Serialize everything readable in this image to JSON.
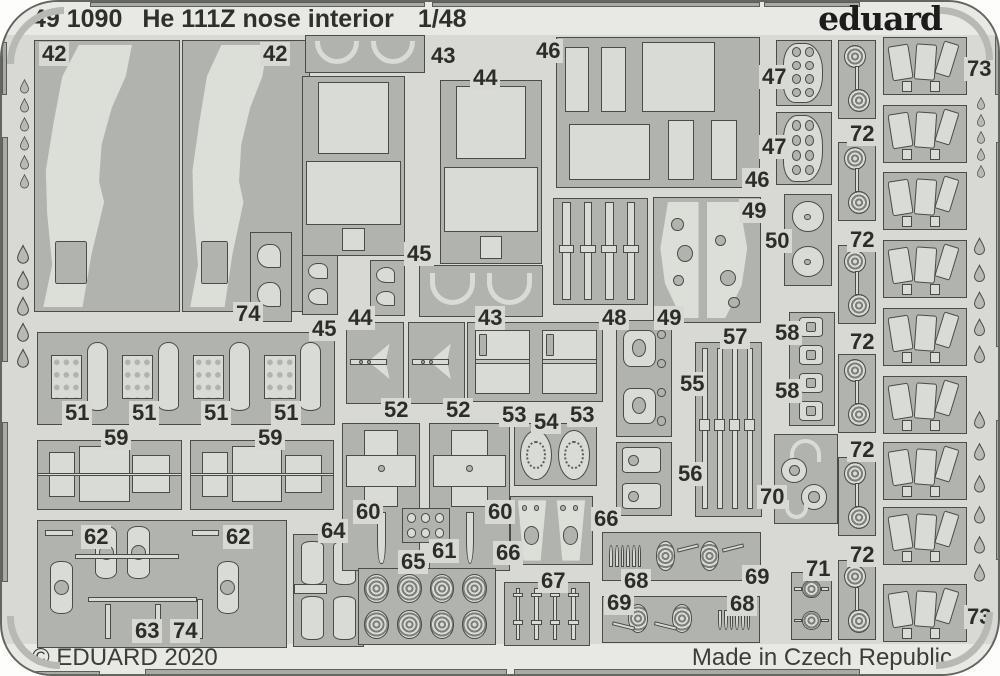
{
  "header": {
    "catalog_number": "49 1090",
    "title": "He 111Z nose interior",
    "scale": "1/48",
    "brand": "eduard"
  },
  "footer": {
    "copyright": "© EDUARD 2020",
    "made_in": "Made in Czech Republic"
  },
  "colors": {
    "sheet": "#d8d9d5",
    "margin_band": "#e8e9e5",
    "cluster_panel": "#b1b4ae",
    "part_fill": "#d9dbd6",
    "outline": "#4a4c46",
    "label_text": "#2b2d29",
    "page": "#fdfdfc"
  },
  "fret": {
    "part_labels": [
      {
        "text": "42",
        "x": 37,
        "y": 40
      },
      {
        "text": "42",
        "x": 258,
        "y": 40
      },
      {
        "text": "43",
        "x": 426,
        "y": 42
      },
      {
        "text": "44",
        "x": 468,
        "y": 64
      },
      {
        "text": "46",
        "x": 531,
        "y": 37
      },
      {
        "text": "47",
        "x": 757,
        "y": 63
      },
      {
        "text": "47",
        "x": 757,
        "y": 133
      },
      {
        "text": "46",
        "x": 740,
        "y": 166
      },
      {
        "text": "49",
        "x": 737,
        "y": 197
      },
      {
        "text": "50",
        "x": 760,
        "y": 227
      },
      {
        "text": "45",
        "x": 402,
        "y": 240
      },
      {
        "text": "74",
        "x": 231,
        "y": 300
      },
      {
        "text": "45",
        "x": 307,
        "y": 315
      },
      {
        "text": "44",
        "x": 343,
        "y": 304
      },
      {
        "text": "43",
        "x": 473,
        "y": 304
      },
      {
        "text": "48",
        "x": 597,
        "y": 304
      },
      {
        "text": "49",
        "x": 652,
        "y": 304
      },
      {
        "text": "51",
        "x": 60,
        "y": 399
      },
      {
        "text": "51",
        "x": 127,
        "y": 399
      },
      {
        "text": "51",
        "x": 199,
        "y": 399
      },
      {
        "text": "51",
        "x": 269,
        "y": 399
      },
      {
        "text": "59",
        "x": 99,
        "y": 424
      },
      {
        "text": "59",
        "x": 253,
        "y": 424
      },
      {
        "text": "52",
        "x": 379,
        "y": 396
      },
      {
        "text": "52",
        "x": 441,
        "y": 396
      },
      {
        "text": "53",
        "x": 497,
        "y": 401
      },
      {
        "text": "53",
        "x": 565,
        "y": 401
      },
      {
        "text": "54",
        "x": 529,
        "y": 408
      },
      {
        "text": "57",
        "x": 718,
        "y": 323
      },
      {
        "text": "55",
        "x": 675,
        "y": 370
      },
      {
        "text": "56",
        "x": 673,
        "y": 460
      },
      {
        "text": "58",
        "x": 770,
        "y": 319
      },
      {
        "text": "58",
        "x": 770,
        "y": 377
      },
      {
        "text": "70",
        "x": 755,
        "y": 483
      },
      {
        "text": "60",
        "x": 351,
        "y": 498
      },
      {
        "text": "60",
        "x": 483,
        "y": 498
      },
      {
        "text": "61",
        "x": 427,
        "y": 537
      },
      {
        "text": "66",
        "x": 589,
        "y": 505
      },
      {
        "text": "66",
        "x": 491,
        "y": 539
      },
      {
        "text": "65",
        "x": 396,
        "y": 548
      },
      {
        "text": "67",
        "x": 536,
        "y": 567
      },
      {
        "text": "68",
        "x": 619,
        "y": 567
      },
      {
        "text": "69",
        "x": 740,
        "y": 563
      },
      {
        "text": "69",
        "x": 602,
        "y": 589
      },
      {
        "text": "68",
        "x": 725,
        "y": 590
      },
      {
        "text": "71",
        "x": 801,
        "y": 555
      },
      {
        "text": "62",
        "x": 79,
        "y": 523
      },
      {
        "text": "62",
        "x": 221,
        "y": 523
      },
      {
        "text": "64",
        "x": 316,
        "y": 517
      },
      {
        "text": "63",
        "x": 130,
        "y": 617
      },
      {
        "text": "74",
        "x": 168,
        "y": 617
      },
      {
        "text": "72",
        "x": 845,
        "y": 120
      },
      {
        "text": "72",
        "x": 845,
        "y": 226
      },
      {
        "text": "72",
        "x": 845,
        "y": 328
      },
      {
        "text": "72",
        "x": 845,
        "y": 436
      },
      {
        "text": "72",
        "x": 845,
        "y": 541
      },
      {
        "text": "73",
        "x": 962,
        "y": 55
      },
      {
        "text": "73",
        "x": 962,
        "y": 603
      }
    ],
    "clusters": [
      {
        "name": "sidewall-42-left",
        "x": 32,
        "y": 38,
        "w": 146,
        "h": 272,
        "motif": "sidewall"
      },
      {
        "name": "sidewall-42-right",
        "x": 180,
        "y": 38,
        "w": 128,
        "h": 272,
        "motif": "sidewall"
      },
      {
        "name": "hooks-74",
        "x": 248,
        "y": 230,
        "w": 42,
        "h": 90,
        "motif": "hooks"
      },
      {
        "name": "arcs-43-top",
        "x": 303,
        "y": 33,
        "w": 120,
        "h": 38,
        "motif": "arcs"
      },
      {
        "name": "bulkhead-44-left",
        "x": 300,
        "y": 74,
        "w": 103,
        "h": 180,
        "motif": "bigpanel"
      },
      {
        "name": "bulkhead-44-right",
        "x": 438,
        "y": 78,
        "w": 102,
        "h": 184,
        "motif": "bigpanel"
      },
      {
        "name": "hooks-45-left",
        "x": 300,
        "y": 253,
        "w": 36,
        "h": 60,
        "motif": "hooks"
      },
      {
        "name": "hooks-45-right",
        "x": 368,
        "y": 258,
        "w": 35,
        "h": 56,
        "motif": "hooks"
      },
      {
        "name": "arcs-43-bottom",
        "x": 417,
        "y": 263,
        "w": 124,
        "h": 52,
        "motif": "arcs"
      },
      {
        "name": "panels-46",
        "x": 554,
        "y": 35,
        "w": 204,
        "h": 151,
        "motif": "panels46"
      },
      {
        "name": "instrument-47-upper",
        "x": 774,
        "y": 38,
        "w": 56,
        "h": 66,
        "motif": "holespanel"
      },
      {
        "name": "instrument-47-lower",
        "x": 774,
        "y": 110,
        "w": 56,
        "h": 73,
        "motif": "holespanel"
      },
      {
        "name": "levers-48",
        "x": 551,
        "y": 196,
        "w": 95,
        "h": 107,
        "motif": "vstrips"
      },
      {
        "name": "frames-49",
        "x": 651,
        "y": 195,
        "w": 108,
        "h": 126,
        "motif": "windshield"
      },
      {
        "name": "wheels-50",
        "x": 782,
        "y": 192,
        "w": 48,
        "h": 92,
        "motif": "twocircv"
      },
      {
        "name": "bottles-51",
        "x": 35,
        "y": 330,
        "w": 298,
        "h": 93,
        "motif": "bottlesrow"
      },
      {
        "name": "dart-52-left",
        "x": 344,
        "y": 320,
        "w": 58,
        "h": 82,
        "motif": "dart"
      },
      {
        "name": "dart-52-right",
        "x": 406,
        "y": 320,
        "w": 57,
        "h": 82,
        "motif": "dart"
      },
      {
        "name": "boxes-53",
        "x": 465,
        "y": 320,
        "w": 136,
        "h": 80,
        "motif": "twoboxes"
      },
      {
        "name": "wheels-54",
        "x": 512,
        "y": 421,
        "w": 83,
        "h": 63,
        "motif": "twocirch"
      },
      {
        "name": "clamps-55",
        "x": 614,
        "y": 318,
        "w": 56,
        "h": 117,
        "motif": "clamps"
      },
      {
        "name": "clamps-56",
        "x": 614,
        "y": 440,
        "w": 56,
        "h": 74,
        "motif": "clamps2"
      },
      {
        "name": "rails-57",
        "x": 693,
        "y": 340,
        "w": 67,
        "h": 175,
        "motif": "vstrips"
      },
      {
        "name": "buckles-58",
        "x": 787,
        "y": 310,
        "w": 46,
        "h": 114,
        "motif": "buckles"
      },
      {
        "name": "hubs-70",
        "x": 772,
        "y": 432,
        "w": 64,
        "h": 90,
        "motif": "hubs"
      },
      {
        "name": "seat-59-left",
        "x": 35,
        "y": 438,
        "w": 145,
        "h": 70,
        "motif": "seat"
      },
      {
        "name": "seat-59-right",
        "x": 188,
        "y": 438,
        "w": 144,
        "h": 70,
        "motif": "seat"
      },
      {
        "name": "extinguishers-62-63-74",
        "x": 35,
        "y": 518,
        "w": 250,
        "h": 128,
        "motif": "extinguishers"
      },
      {
        "name": "extinguishers-64",
        "x": 291,
        "y": 532,
        "w": 71,
        "h": 113,
        "motif": "ext2"
      },
      {
        "name": "cross-60-left",
        "x": 340,
        "y": 421,
        "w": 78,
        "h": 148,
        "motif": "cross"
      },
      {
        "name": "cross-60-right",
        "x": 427,
        "y": 421,
        "w": 81,
        "h": 148,
        "motif": "cross"
      },
      {
        "name": "links-61",
        "x": 400,
        "y": 506,
        "w": 48,
        "h": 35,
        "motif": "smallgrid"
      },
      {
        "name": "seatbacks-66",
        "x": 508,
        "y": 494,
        "w": 83,
        "h": 69,
        "motif": "seatbacks"
      },
      {
        "name": "spirals-65",
        "x": 356,
        "y": 566,
        "w": 138,
        "h": 77,
        "motif": "spirals"
      },
      {
        "name": "pins-67",
        "x": 502,
        "y": 580,
        "w": 86,
        "h": 64,
        "motif": "pins"
      },
      {
        "name": "ammo-68-69",
        "x": 600,
        "y": 530,
        "w": 159,
        "h": 49,
        "motif": "ammo"
      },
      {
        "name": "ammo-69-68",
        "x": 600,
        "y": 594,
        "w": 158,
        "h": 47,
        "motif": "ammoflip"
      },
      {
        "name": "rosettes-71",
        "x": 789,
        "y": 570,
        "w": 41,
        "h": 68,
        "motif": "rosettes2"
      },
      {
        "name": "rosette-72-1",
        "x": 836,
        "y": 38,
        "w": 38,
        "h": 79,
        "motif": "rosettepair"
      },
      {
        "name": "rosette-72-2",
        "x": 836,
        "y": 140,
        "w": 38,
        "h": 79,
        "motif": "rosettepair"
      },
      {
        "name": "rosette-72-3",
        "x": 836,
        "y": 243,
        "w": 38,
        "h": 79,
        "motif": "rosettepair"
      },
      {
        "name": "rosette-72-4",
        "x": 836,
        "y": 352,
        "w": 38,
        "h": 79,
        "motif": "rosettepair"
      },
      {
        "name": "rosette-72-5",
        "x": 836,
        "y": 455,
        "w": 38,
        "h": 79,
        "motif": "rosettepair"
      },
      {
        "name": "rosette-72-6",
        "x": 836,
        "y": 558,
        "w": 38,
        "h": 80,
        "motif": "rosettepair"
      },
      {
        "name": "canvas-73-1",
        "x": 881,
        "y": 35,
        "w": 84,
        "h": 58,
        "motif": "trapezoids"
      },
      {
        "name": "canvas-73-2",
        "x": 881,
        "y": 103,
        "w": 84,
        "h": 58,
        "motif": "trapezoids"
      },
      {
        "name": "canvas-73-3",
        "x": 881,
        "y": 170,
        "w": 84,
        "h": 58,
        "motif": "trapezoids"
      },
      {
        "name": "canvas-73-4",
        "x": 881,
        "y": 238,
        "w": 84,
        "h": 58,
        "motif": "trapezoids"
      },
      {
        "name": "canvas-73-5",
        "x": 881,
        "y": 306,
        "w": 84,
        "h": 58,
        "motif": "trapezoids"
      },
      {
        "name": "canvas-73-6",
        "x": 881,
        "y": 374,
        "w": 84,
        "h": 58,
        "motif": "trapezoids"
      },
      {
        "name": "canvas-73-7",
        "x": 881,
        "y": 440,
        "w": 84,
        "h": 58,
        "motif": "trapezoids"
      },
      {
        "name": "canvas-73-8",
        "x": 881,
        "y": 505,
        "w": 84,
        "h": 58,
        "motif": "trapezoids"
      },
      {
        "name": "canvas-73-9",
        "x": 881,
        "y": 582,
        "w": 84,
        "h": 58,
        "motif": "trapezoids"
      }
    ],
    "teardrops": [
      {
        "x": 18,
        "y": 77,
        "w": 9,
        "h": 15
      },
      {
        "x": 18,
        "y": 96,
        "w": 9,
        "h": 15
      },
      {
        "x": 18,
        "y": 115,
        "w": 9,
        "h": 15
      },
      {
        "x": 18,
        "y": 134,
        "w": 9,
        "h": 15
      },
      {
        "x": 18,
        "y": 153,
        "w": 9,
        "h": 15
      },
      {
        "x": 18,
        "y": 172,
        "w": 9,
        "h": 15
      },
      {
        "x": 15,
        "y": 242,
        "w": 12,
        "h": 21
      },
      {
        "x": 15,
        "y": 268,
        "w": 12,
        "h": 21
      },
      {
        "x": 15,
        "y": 294,
        "w": 12,
        "h": 21
      },
      {
        "x": 15,
        "y": 320,
        "w": 12,
        "h": 21
      },
      {
        "x": 15,
        "y": 346,
        "w": 12,
        "h": 21
      },
      {
        "x": 975,
        "y": 95,
        "w": 8,
        "h": 13
      },
      {
        "x": 975,
        "y": 112,
        "w": 8,
        "h": 13
      },
      {
        "x": 975,
        "y": 129,
        "w": 8,
        "h": 13
      },
      {
        "x": 975,
        "y": 146,
        "w": 8,
        "h": 13
      },
      {
        "x": 975,
        "y": 163,
        "w": 8,
        "h": 13
      },
      {
        "x": 972,
        "y": 235,
        "w": 11,
        "h": 19
      },
      {
        "x": 972,
        "y": 262,
        "w": 11,
        "h": 19
      },
      {
        "x": 972,
        "y": 289,
        "w": 11,
        "h": 19
      },
      {
        "x": 972,
        "y": 316,
        "w": 11,
        "h": 19
      },
      {
        "x": 972,
        "y": 343,
        "w": 11,
        "h": 19
      },
      {
        "x": 972,
        "y": 408,
        "w": 11,
        "h": 20
      },
      {
        "x": 972,
        "y": 440,
        "w": 11,
        "h": 20
      },
      {
        "x": 972,
        "y": 472,
        "w": 11,
        "h": 20
      },
      {
        "x": 972,
        "y": 503,
        "w": 11,
        "h": 20
      },
      {
        "x": 972,
        "y": 533,
        "w": 11,
        "h": 20
      },
      {
        "x": 972,
        "y": 561,
        "w": 11,
        "h": 20
      }
    ],
    "edge_bars": [
      {
        "x": 88,
        "y": 0,
        "w": 335,
        "h": 5
      },
      {
        "x": 430,
        "y": 0,
        "w": 328,
        "h": 5
      },
      {
        "x": 762,
        "y": 0,
        "w": 96,
        "h": 5
      },
      {
        "x": 30,
        "y": 669,
        "w": 68,
        "h": 7
      },
      {
        "x": 143,
        "y": 667,
        "w": 362,
        "h": 8
      },
      {
        "x": 512,
        "y": 667,
        "w": 346,
        "h": 8
      },
      {
        "x": 0,
        "y": 40,
        "w": 5,
        "h": 53
      },
      {
        "x": 0,
        "y": 135,
        "w": 6,
        "h": 225
      },
      {
        "x": 0,
        "y": 420,
        "w": 6,
        "h": 160
      },
      {
        "x": 993,
        "y": 33,
        "w": 7,
        "h": 60
      },
      {
        "x": 994,
        "y": 140,
        "w": 6,
        "h": 205
      },
      {
        "x": 994,
        "y": 418,
        "w": 6,
        "h": 140
      }
    ]
  }
}
